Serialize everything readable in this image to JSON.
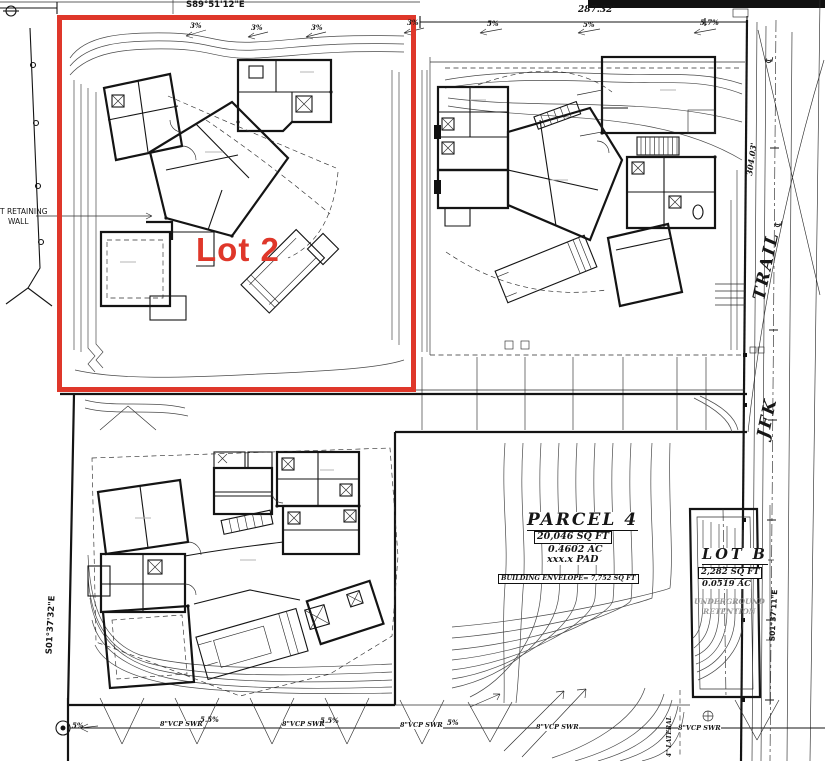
{
  "colors": {
    "highlight_red": "#df372a",
    "drawing_ink": "#161616",
    "muted_gray": "#9a9a9a"
  },
  "lot2": {
    "label": "Lot 2"
  },
  "survey": {
    "bearing_top": "S89°51'12\"E",
    "dim_top_right": "287.32'",
    "dim_right": "304.03'",
    "bearing_left": "S01°37'32\"E",
    "bearing_lot_b": "S01°37'11\"E",
    "centerline_symbol": "℄"
  },
  "street": {
    "name_word1": "JFK",
    "name_word2": "TRAIL"
  },
  "labels": {
    "retaining_wall_line1": "T RETAINING",
    "retaining_wall_line2": "WALL"
  },
  "parcel4": {
    "title": "PARCEL 4",
    "area_sqft": "20,046 SQ FT",
    "area_ac": "0.4602 AC",
    "pad": "xxx.x PAD",
    "building_envelope": "BUILDING ENVELOPE= 7,752 SQ FT"
  },
  "lot_b": {
    "title": "LOT B",
    "area_sqft": "2,282 SQ FT",
    "area_ac": "0.0519 AC",
    "note_line1": "UNDERGROUND",
    "note_line2": "RETENTION"
  },
  "sewer": {
    "labels": [
      "8\"VCP SWR",
      "8\"VCP SWR",
      "8\"VCP SWR",
      "8\"VCP SWR",
      "8\"VCP SWR"
    ],
    "lateral_label": "4\" LATERAL"
  },
  "slopes": {
    "top": [
      "3%",
      "3%",
      "3%",
      "3%",
      "5%",
      "5%",
      "5.7%"
    ],
    "bottom": [
      "5%",
      "5.5%",
      "5.5%",
      "5%"
    ]
  }
}
